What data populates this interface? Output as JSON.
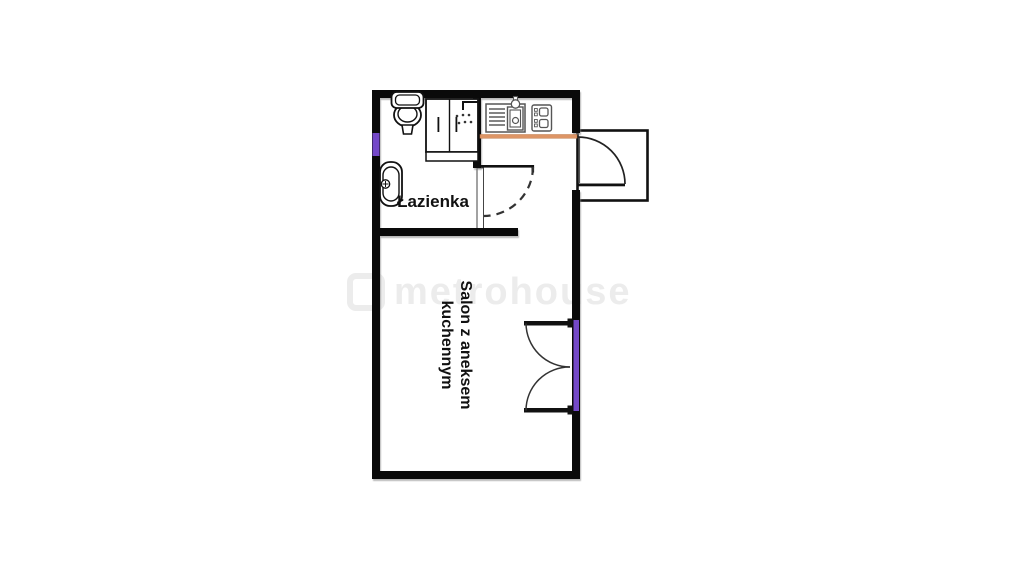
{
  "watermark": {
    "text": "metrohouse"
  },
  "rooms": {
    "bathroom": {
      "label": "Łazienka"
    },
    "living_room": {
      "label_line1": "Salon z aneksem",
      "label_line2": "kuchennym"
    }
  },
  "colors": {
    "wall": "#0a0a0a",
    "counter_orange": "#dd9566",
    "counter_edge": "#c07a4a",
    "window_marker_purple": "#7448c8",
    "watermark_gray": "#ececec",
    "fixture_gray": "#555555",
    "arc_dark": "#2a2a2a"
  }
}
